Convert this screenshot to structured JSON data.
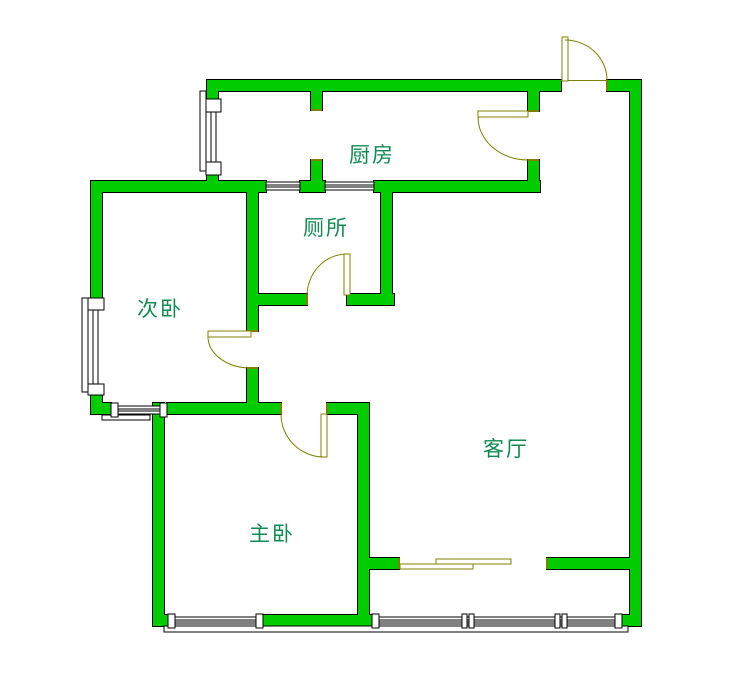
{
  "floorplan": {
    "rooms": [
      {
        "id": "kitchen",
        "label": "厨房"
      },
      {
        "id": "toilet",
        "label": "厕所"
      },
      {
        "id": "secondary-bedroom",
        "label": "次卧"
      },
      {
        "id": "master-bedroom",
        "label": "主卧"
      },
      {
        "id": "living-room",
        "label": "客厅"
      }
    ],
    "colors": {
      "wall_fill": "#00cc00",
      "wall_outline": "#000000",
      "door_window_symbol": "#808000",
      "room_label_text": "#108a50",
      "background": "#ffffff"
    }
  }
}
